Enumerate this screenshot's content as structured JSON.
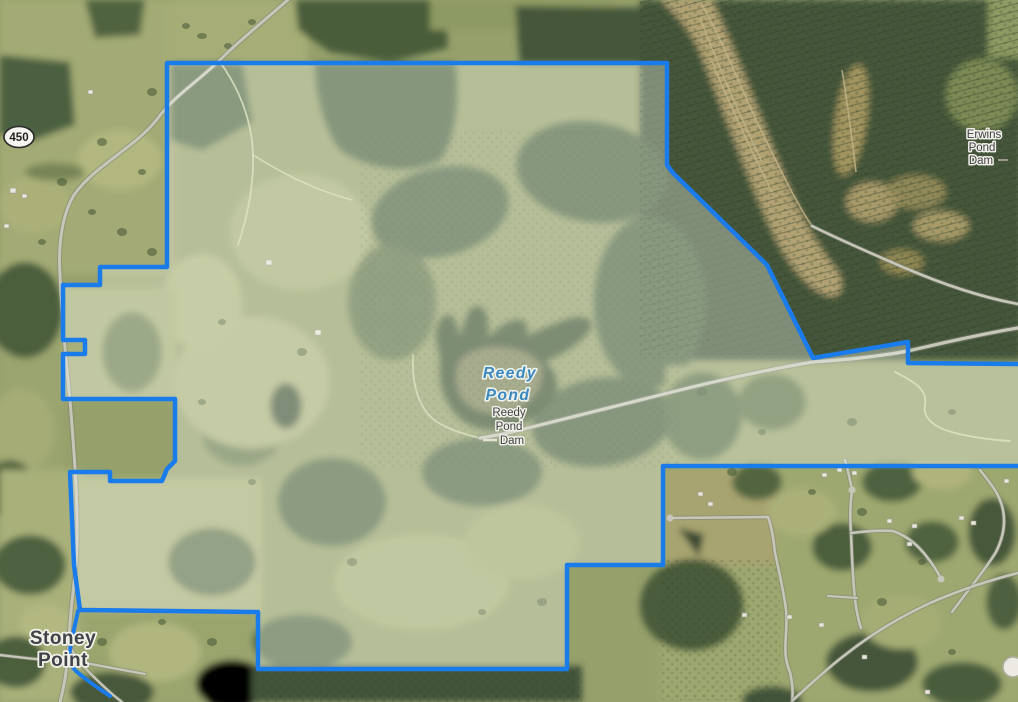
{
  "map": {
    "view": "satellite-imagery",
    "labels": {
      "route_shield": {
        "number": "450"
      },
      "erwins_pond_dam": {
        "lines": [
          "Erwins",
          "Pond",
          "Dam"
        ]
      },
      "reedy_pond": {
        "lines": [
          "Reedy",
          "Pond"
        ]
      },
      "reedy_pond_dam": {
        "lines": [
          "Reedy",
          "Pond",
          "Dam"
        ]
      },
      "stoney_point": {
        "lines": [
          "Stoney",
          "Point"
        ]
      }
    },
    "colors": {
      "parcel_boundary_blue": "#1a7bea",
      "water_label_blue": "#3b88c0",
      "place_label_gray": "#3d4043",
      "label_halo": "#f2f1e9"
    }
  }
}
